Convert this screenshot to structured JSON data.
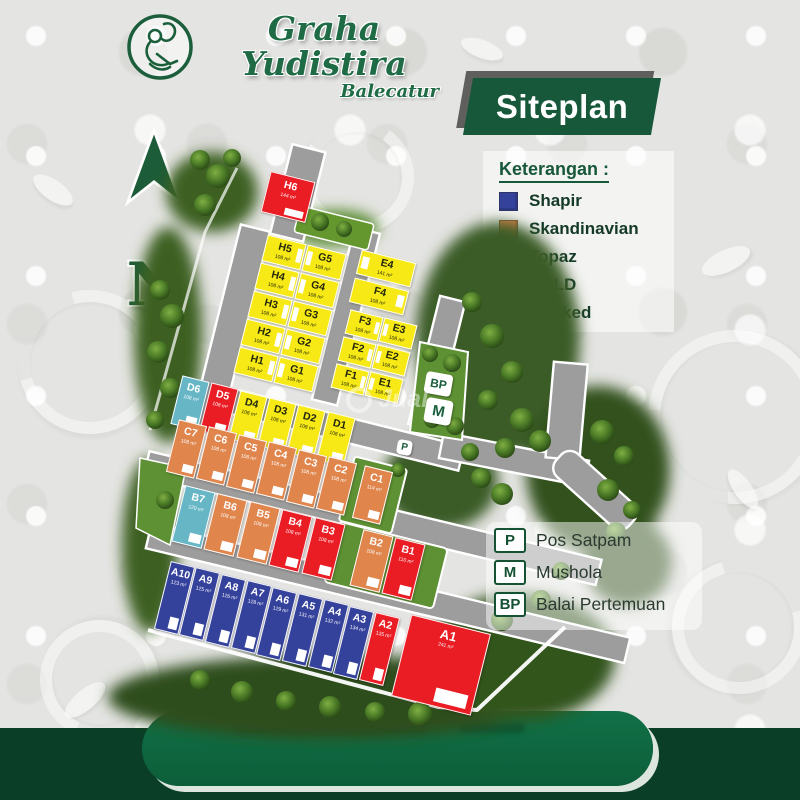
{
  "header": {
    "title": "Graha Yudistira",
    "subtitle": "Balecatur",
    "logo_icon": "wayang-logo-icon"
  },
  "banner": {
    "label": "Siteplan"
  },
  "legend": {
    "title": "Keterangan :",
    "items": [
      {
        "label": "Shapir",
        "color": "#35429c"
      },
      {
        "label": "Skandinavian",
        "color": "#e0854c"
      },
      {
        "label": "Topaz",
        "color": "#f7e915"
      },
      {
        "label": "SOLD",
        "color": "#ea1c24"
      },
      {
        "label": "Booked",
        "color": "#66b6c6"
      }
    ]
  },
  "compass": {
    "label": "N"
  },
  "facilities": [
    {
      "code": "P",
      "label": "Pos Satpam"
    },
    {
      "code": "M",
      "label": "Mushola"
    },
    {
      "code": "BP",
      "label": "Balai Pertemuan"
    }
  ],
  "watermark": {
    "text": "Jual"
  },
  "map": {
    "markers": [
      {
        "code": "BP"
      },
      {
        "code": "M"
      },
      {
        "code": "P"
      }
    ],
    "blocks": {
      "H6": [
        {
          "id": "H6",
          "area": "144 m²",
          "type": "sold"
        }
      ],
      "H": [
        {
          "id": "H5",
          "area": "108 m²",
          "type": "topaz"
        },
        {
          "id": "H4",
          "area": "108 m²",
          "type": "topaz"
        },
        {
          "id": "H3",
          "area": "108 m²",
          "type": "topaz"
        },
        {
          "id": "H2",
          "area": "108 m²",
          "type": "topaz"
        },
        {
          "id": "H1",
          "area": "108 m²",
          "type": "topaz"
        }
      ],
      "G": [
        {
          "id": "G5",
          "area": "108 m²",
          "type": "topaz"
        },
        {
          "id": "G4",
          "area": "108 m²",
          "type": "topaz"
        },
        {
          "id": "G3",
          "area": "108 m²",
          "type": "topaz"
        },
        {
          "id": "G2",
          "area": "108 m²",
          "type": "topaz"
        },
        {
          "id": "G1",
          "area": "108 m²",
          "type": "topaz"
        }
      ],
      "E4": [
        {
          "id": "E4",
          "area": "141 m²",
          "type": "topaz"
        }
      ],
      "F4": [
        {
          "id": "F4",
          "area": "108 m²",
          "type": "topaz"
        }
      ],
      "F": [
        {
          "id": "F3",
          "area": "108 m²",
          "type": "topaz"
        },
        {
          "id": "F2",
          "area": "108 m²",
          "type": "topaz"
        },
        {
          "id": "F1",
          "area": "108 m²",
          "type": "topaz"
        }
      ],
      "E": [
        {
          "id": "E3",
          "area": "108 m²",
          "type": "topaz"
        },
        {
          "id": "E2",
          "area": "108 m²",
          "type": "topaz"
        },
        {
          "id": "E1",
          "area": "108 m²",
          "type": "topaz"
        }
      ],
      "D": [
        {
          "id": "D6",
          "area": "108 m²",
          "type": "booked"
        },
        {
          "id": "D5",
          "area": "108 m²",
          "type": "sold"
        },
        {
          "id": "D4",
          "area": "108 m²",
          "type": "topaz"
        },
        {
          "id": "D3",
          "area": "108 m²",
          "type": "topaz"
        },
        {
          "id": "D2",
          "area": "108 m²",
          "type": "topaz"
        },
        {
          "id": "D1",
          "area": "108 m²",
          "type": "topaz"
        }
      ],
      "C": [
        {
          "id": "C7",
          "area": "108 m²",
          "type": "skandinavian"
        },
        {
          "id": "C6",
          "area": "108 m²",
          "type": "skandinavian"
        },
        {
          "id": "C5",
          "area": "108 m²",
          "type": "skandinavian"
        },
        {
          "id": "C4",
          "area": "108 m²",
          "type": "skandinavian"
        },
        {
          "id": "C3",
          "area": "108 m²",
          "type": "skandinavian"
        },
        {
          "id": "C2",
          "area": "108 m²",
          "type": "skandinavian"
        },
        {
          "id": "C1",
          "area": "114 m²",
          "type": "skandinavian"
        }
      ],
      "B": [
        {
          "id": "B7",
          "area": "120 m²",
          "type": "booked"
        },
        {
          "id": "B6",
          "area": "108 m²",
          "type": "skandinavian"
        },
        {
          "id": "B5",
          "area": "108 m²",
          "type": "skandinavian"
        },
        {
          "id": "B4",
          "area": "108 m²",
          "type": "sold"
        },
        {
          "id": "B3",
          "area": "108 m²",
          "type": "sold"
        },
        {
          "id": "B2",
          "area": "108 m²",
          "type": "skandinavian"
        },
        {
          "id": "B1",
          "area": "110 m²",
          "type": "sold"
        }
      ],
      "A": [
        {
          "id": "A10",
          "area": "123 m²",
          "type": "shapir"
        },
        {
          "id": "A9",
          "area": "125 m²",
          "type": "shapir"
        },
        {
          "id": "A8",
          "area": "126 m²",
          "type": "shapir"
        },
        {
          "id": "A7",
          "area": "128 m²",
          "type": "shapir"
        },
        {
          "id": "A6",
          "area": "129 m²",
          "type": "shapir"
        },
        {
          "id": "A5",
          "area": "131 m²",
          "type": "shapir"
        },
        {
          "id": "A4",
          "area": "132 m²",
          "type": "shapir"
        },
        {
          "id": "A3",
          "area": "134 m²",
          "type": "shapir"
        },
        {
          "id": "A2",
          "area": "135 m²",
          "type": "sold"
        },
        {
          "id": "A1",
          "area": "241 m²",
          "type": "sold"
        }
      ]
    }
  }
}
